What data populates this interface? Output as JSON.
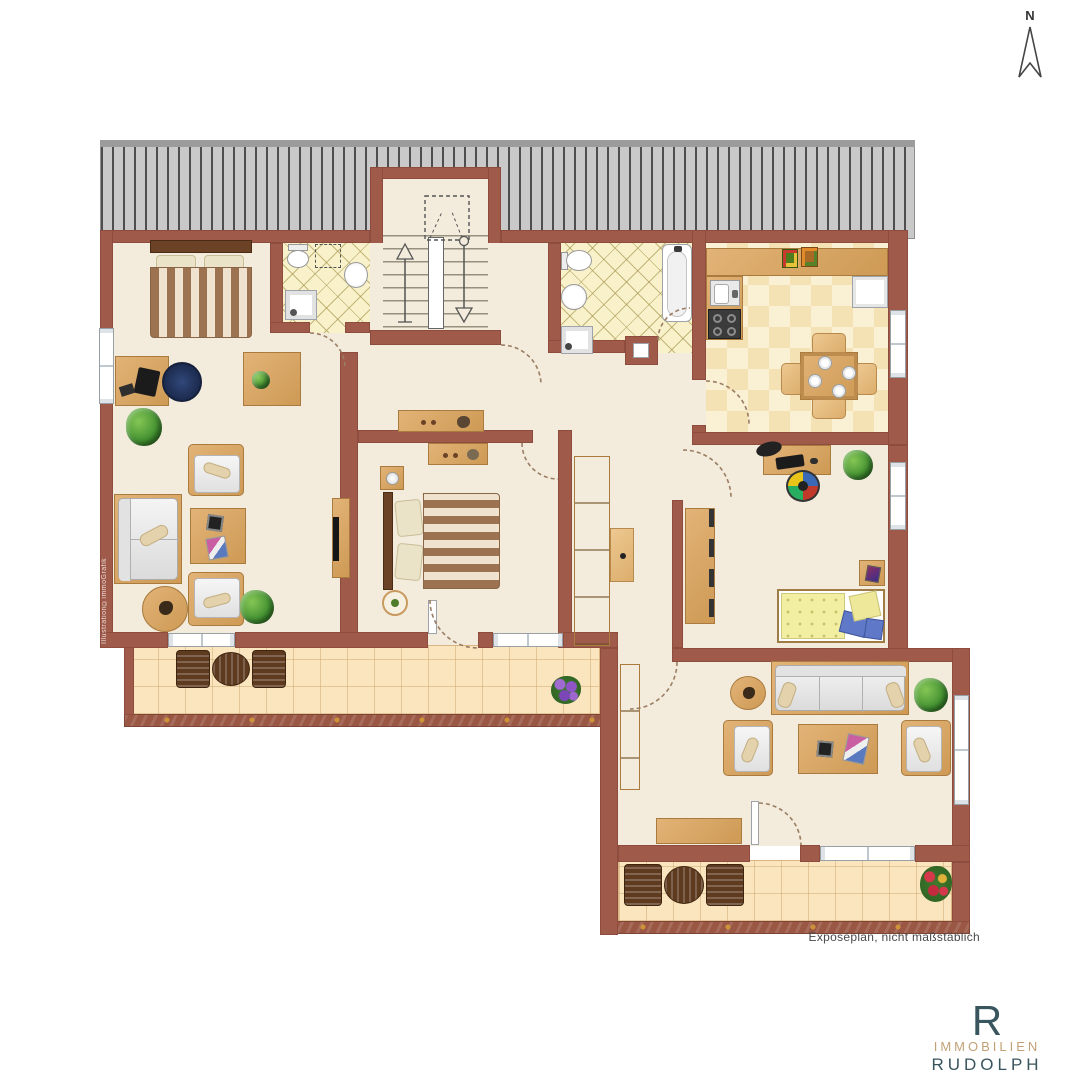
{
  "compass": {
    "label": "N"
  },
  "watermark": "Illustration©immoGrafik",
  "footer": {
    "note": "Exposéplan, nicht maßstäblich"
  },
  "logo": {
    "monogram": "R",
    "line1": "IMMOBILIEN",
    "line2": "RUDOLPH"
  },
  "colors": {
    "wall": "#A05A4A",
    "floor": "#F3ECDC",
    "bath_tile": "#F8F1C9",
    "kitchen_tile": "#F7E8C4",
    "balcony_tile": "#FAE5BE",
    "roof": "#C9C9C9",
    "wood": "#D8A963",
    "wood_dark": "#6B4226",
    "logo_blue": "#39555E",
    "logo_tan": "#C2A178"
  },
  "icons": [
    "north-arrow-icon",
    "stair-up-arrow-icon",
    "stair-down-arrow-icon",
    "door-swing-arc-icon",
    "toilet-icon",
    "sink-icon",
    "shower-icon",
    "bathtub-icon",
    "stove-icon",
    "kitchen-sink-icon",
    "plant-icon",
    "flower-pot-icon",
    "bed-icon",
    "sofa-icon",
    "armchair-icon",
    "desk-icon",
    "dining-table-icon",
    "wardrobe-icon",
    "balcony-chair-icon"
  ]
}
